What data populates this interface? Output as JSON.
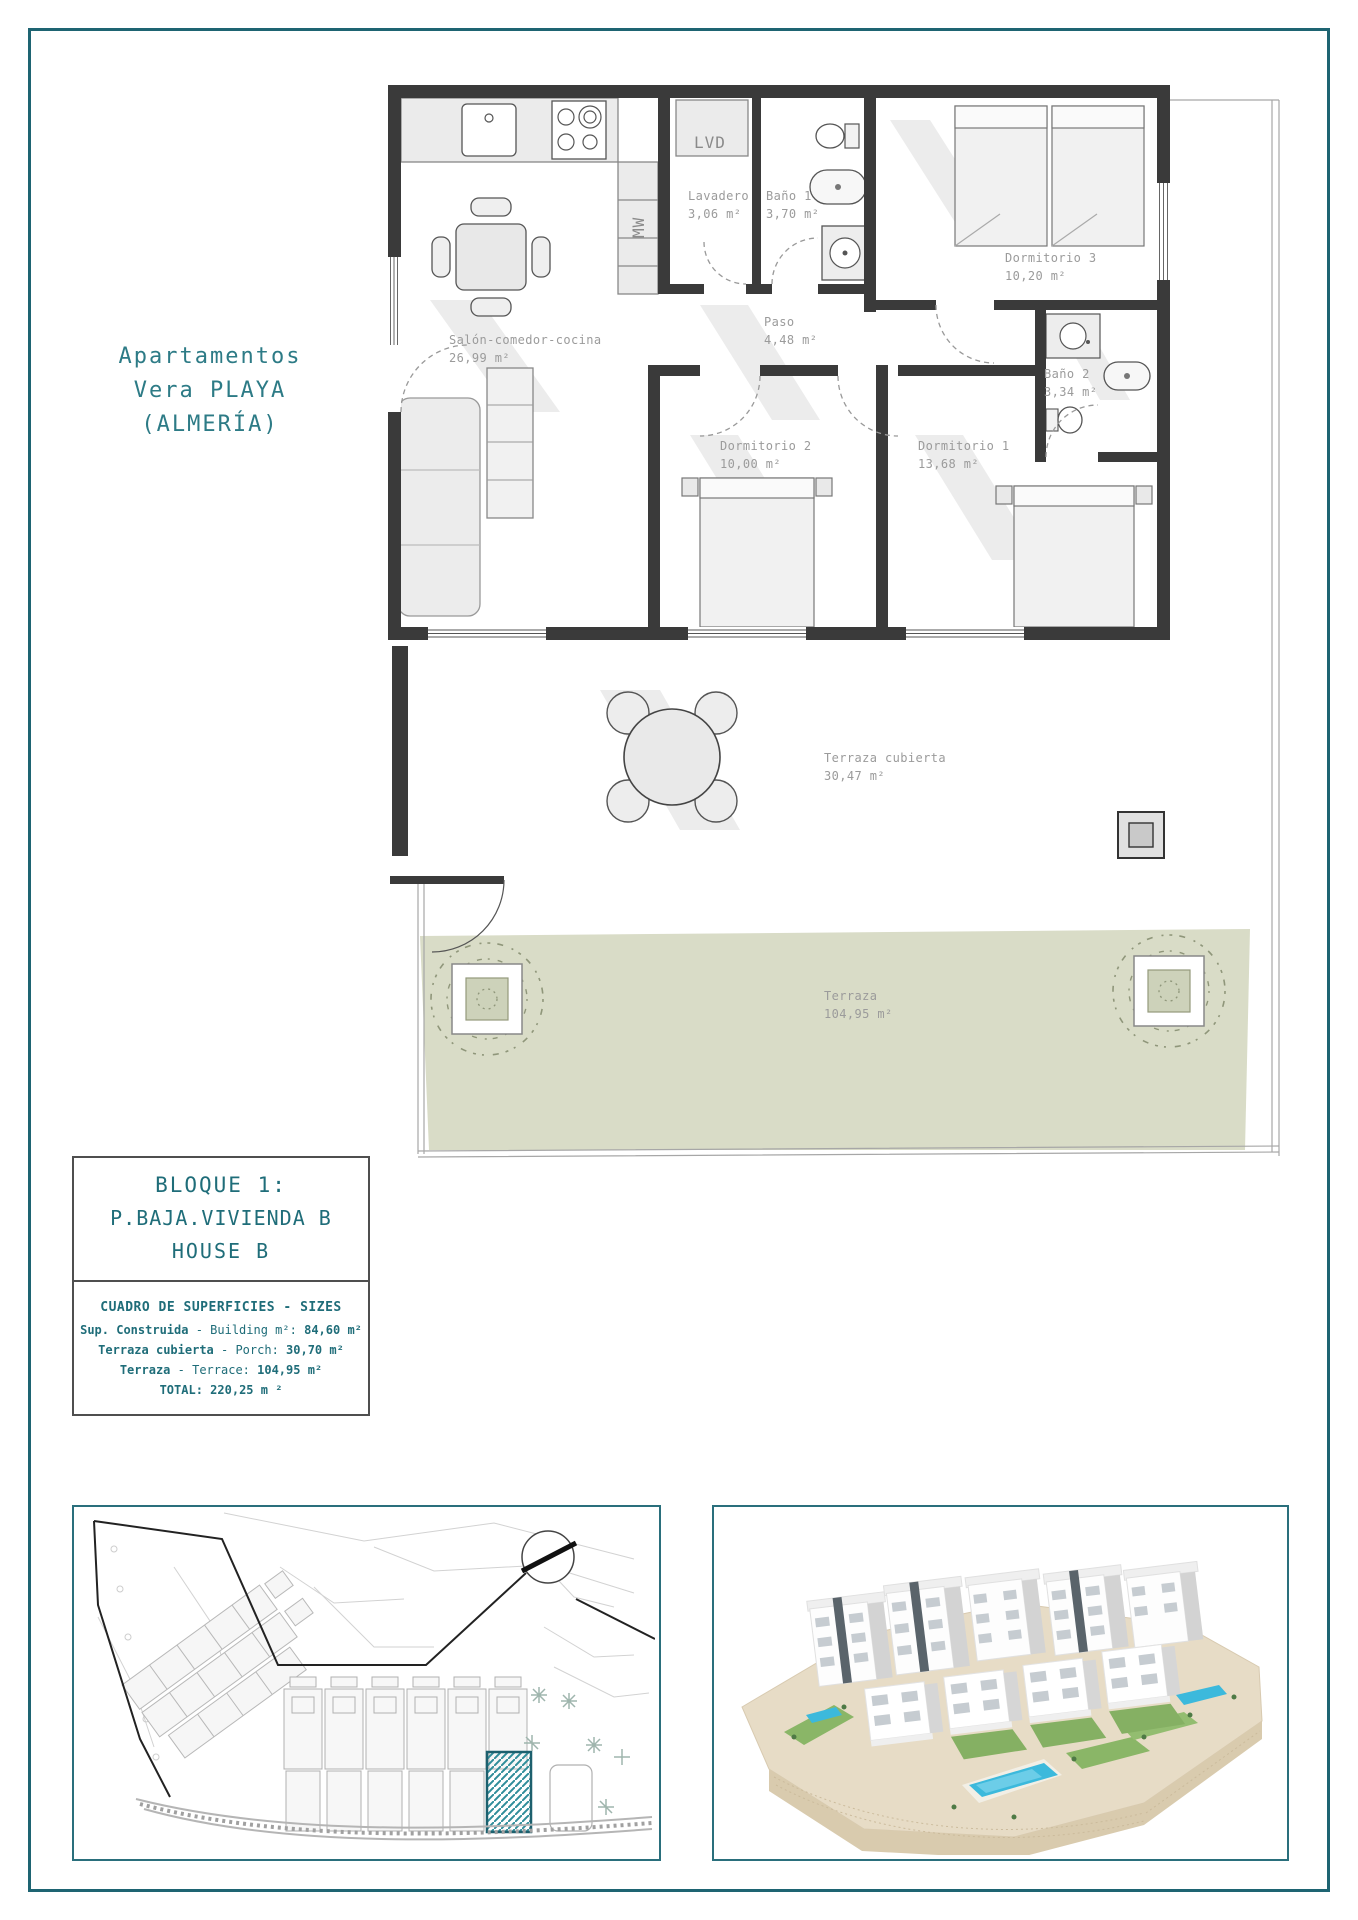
{
  "header": {
    "title_lines": [
      "Apartamentos",
      "Vera PLAYA",
      "(ALMERÍA)"
    ]
  },
  "plan": {
    "rooms": [
      {
        "name": "Salón-comedor-cocina",
        "area": "26,99 m²"
      },
      {
        "name": "Lavadero",
        "area": "3,06 m²"
      },
      {
        "name": "Baño 1",
        "area": "3,70 m²"
      },
      {
        "name": "Dormitorio 3",
        "area": "10,20 m²"
      },
      {
        "name": "Paso",
        "area": "4,48 m²"
      },
      {
        "name": "Baño 2",
        "area": "3,34 m²"
      },
      {
        "name": "Dormitorio 2",
        "area": "10,00 m²"
      },
      {
        "name": "Dormitorio 1",
        "area": "13,68 m²"
      },
      {
        "name": "Terraza cubierta",
        "area": "30,47 m²"
      },
      {
        "name": "Terraza",
        "area": "104,95 m²"
      }
    ],
    "labels": {
      "lvd": "LVD",
      "mw": "MW"
    }
  },
  "info_box": {
    "line1": "BLOQUE 1:",
    "line2": "P.BAJA.VIVIENDA B",
    "line3": "HOUSE B",
    "table_title": "CUADRO DE SUPERFICIES  - SIZES",
    "rows": [
      {
        "es": "Sup. Construida",
        "en": "- Building m²:",
        "value": "84,60 m²"
      },
      {
        "es": "Terraza cubierta",
        "en": "- Porch:",
        "value": "30,70 m²"
      },
      {
        "es": "Terraza",
        "en": "- Terrace:",
        "value": "104,95 m²"
      },
      {
        "es": "TOTAL:",
        "en": "",
        "value": "220,25 m ²"
      }
    ]
  },
  "colors": {
    "accent_teal": "#2d7b86",
    "page_border": "#1e6472",
    "terrace_green": "#d9dcc7",
    "site_hatch": "#2f8d9a",
    "pool_blue": "#3cb9dc",
    "plan_text_grey": "#9b9b9b",
    "wall_dark": "#3a3a3a"
  }
}
